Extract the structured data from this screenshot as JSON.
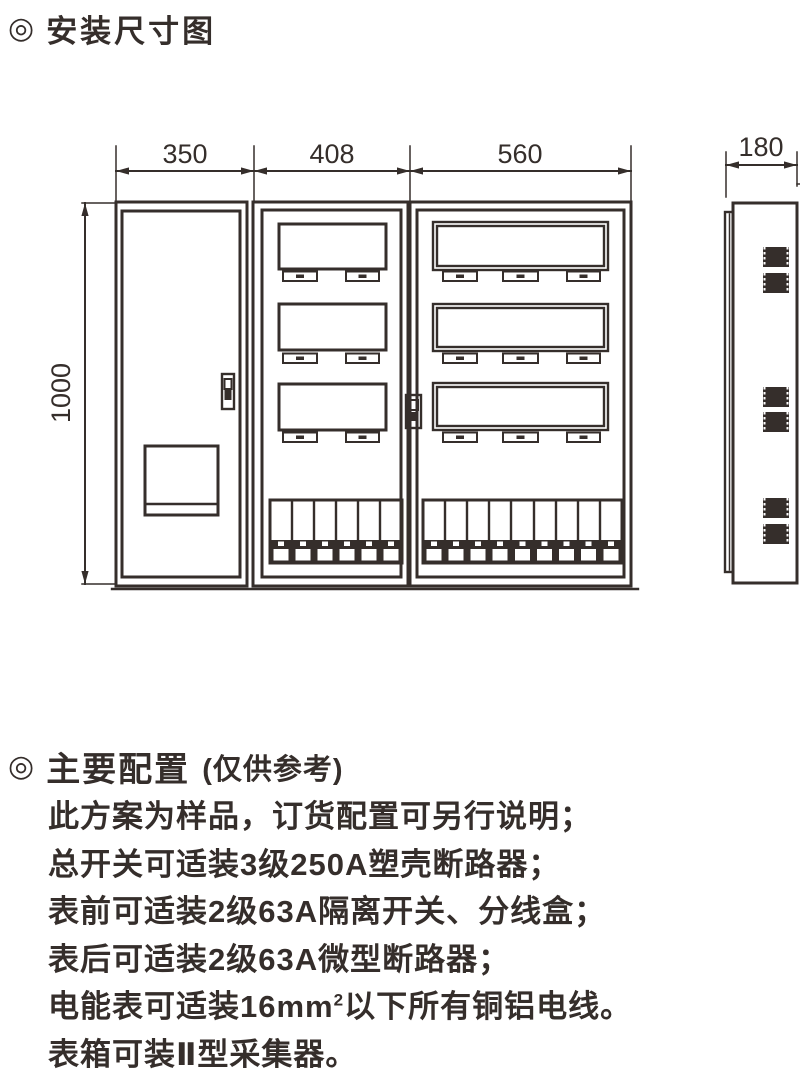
{
  "section1": {
    "bullet": "◎",
    "title": "安装尺寸图"
  },
  "diagram": {
    "dimensions": {
      "left_width": "350",
      "middle_width": "408",
      "right_width": "560",
      "height": "1000",
      "depth": "180"
    }
  },
  "section2": {
    "bullet": "◎",
    "title": "主要配置",
    "subtitle": "(仅供参考)"
  },
  "notes": [
    {
      "text": "此方案为样品，订货配置可另行说明；"
    },
    {
      "text": "总开关可适装3级250A塑壳断路器；"
    },
    {
      "text": "表前可适装2级63A隔离开关、分线盒；"
    },
    {
      "text": "表后可适装2级63A微型断路器；"
    },
    {
      "pre": "电能表可适装16mm",
      "sup": "2",
      "post": "以下所有铜铝电线。"
    },
    {
      "text": "表箱可装Ⅱ型采集器。"
    }
  ]
}
